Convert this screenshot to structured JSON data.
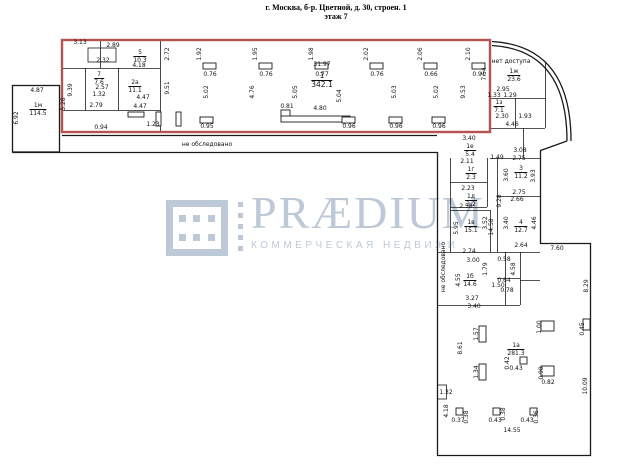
{
  "title": {
    "line1": "г. Москва, б-р. Цветной, д. 30, строен. 1",
    "line2": "этаж 7"
  },
  "watermark": {
    "brand": "PRÆDIUM",
    "tagline": "КОММЕРЧЕСКАЯ НЕДВИЖИМОСТЬ"
  },
  "colors": {
    "wall": "#1a1a1a",
    "highlight": "#b5534f",
    "watermark": "#bdc9d6"
  },
  "notes": {
    "no_access": "нет доступа",
    "not_surveyed": "не обследовано"
  },
  "rooms": [
    [
      "1",
      "342.1",
      322,
      72,
      1
    ],
    [
      "5",
      "10.3",
      140,
      49,
      0
    ],
    [
      "7",
      "7.6",
      99,
      71,
      0
    ],
    [
      "2а",
      "11.1",
      135,
      79,
      0
    ],
    [
      "1м",
      "114.5",
      38,
      102,
      0
    ],
    [
      "1ж",
      "23.6",
      514,
      68,
      0
    ],
    [
      "1з",
      "7.1",
      499,
      99,
      0
    ],
    [
      "1е",
      "5.4",
      470,
      143,
      0
    ],
    [
      "1г",
      "2.3",
      471,
      166,
      0
    ],
    [
      "1д",
      "2.2",
      471,
      193,
      0
    ],
    [
      "1в",
      "15.1",
      471,
      219,
      0
    ],
    [
      "3",
      "11.2",
      521,
      165,
      0
    ],
    [
      "4",
      "12.7",
      521,
      219,
      0
    ],
    [
      "1б",
      "14.6",
      470,
      273,
      0
    ],
    [
      "1а",
      "281.3",
      516,
      342,
      0
    ]
  ],
  "annotations": [
    [
      "1.92",
      200,
      54,
      1
    ],
    [
      "1.95",
      256,
      54,
      1
    ],
    [
      "1.98",
      312,
      54,
      1
    ],
    [
      "2.02",
      367,
      54,
      1
    ],
    [
      "2.06",
      421,
      54,
      1
    ],
    [
      "2.10",
      469,
      54,
      1
    ],
    [
      "0.76",
      210,
      75,
      0
    ],
    [
      "0.76",
      266,
      75,
      0
    ],
    [
      "0.77",
      322,
      75,
      0
    ],
    [
      "0.76",
      377,
      75,
      0
    ],
    [
      "0.66",
      431,
      75,
      0
    ],
    [
      "0.91",
      479,
      75,
      0
    ],
    [
      "31.97",
      322,
      65,
      0
    ],
    [
      "5.02",
      207,
      92,
      1
    ],
    [
      "4.76",
      253,
      92,
      1
    ],
    [
      "5.05",
      296,
      92,
      1
    ],
    [
      "5.04",
      340,
      96,
      1
    ],
    [
      "5.03",
      395,
      92,
      1
    ],
    [
      "5.02",
      437,
      92,
      1
    ],
    [
      "9.53",
      464,
      92,
      1
    ],
    [
      "7.54",
      485,
      74,
      1
    ],
    [
      "0.95",
      207,
      127,
      0
    ],
    [
      "0.81",
      287,
      107,
      0
    ],
    [
      "4.80",
      320,
      109,
      0
    ],
    [
      "0.96",
      349,
      127,
      0
    ],
    [
      "0.96",
      396,
      127,
      0
    ],
    [
      "0.96",
      439,
      127,
      0
    ],
    [
      "2.72",
      168,
      54,
      1
    ],
    [
      "9.51",
      168,
      88,
      1
    ],
    [
      "3.13",
      80,
      43,
      0
    ],
    [
      "2.89",
      113,
      46,
      0
    ],
    [
      "2.32",
      103,
      61,
      0
    ],
    [
      "4.18",
      139,
      66,
      0
    ],
    [
      "2.57",
      102,
      88,
      0
    ],
    [
      "1.32",
      99,
      95,
      0
    ],
    [
      "4.47",
      143,
      98,
      0
    ],
    [
      "2.79",
      96,
      106,
      0
    ],
    [
      "4.47",
      140,
      107,
      0
    ],
    [
      "0.94",
      101,
      128,
      0
    ],
    [
      "1.23",
      153,
      125,
      0
    ],
    [
      "9.39",
      71,
      90,
      1
    ],
    [
      "5.28",
      64,
      104,
      1
    ],
    [
      "4.87",
      37,
      91,
      0
    ],
    [
      "6.92",
      17,
      118,
      1
    ],
    [
      "не обследовано",
      207,
      145,
      0
    ],
    [
      "нет доступа",
      511,
      62,
      0
    ],
    [
      "2.95",
      503,
      90,
      0
    ],
    [
      "1.33",
      494,
      96,
      0
    ],
    [
      "1.29",
      510,
      96,
      0
    ],
    [
      "2.30",
      502,
      117,
      0
    ],
    [
      "1.93",
      525,
      117,
      0
    ],
    [
      "4.46",
      512,
      125,
      0
    ],
    [
      "3.08",
      520,
      151,
      0
    ],
    [
      "1.49",
      497,
      158,
      0
    ],
    [
      "3.40",
      469,
      139,
      0
    ],
    [
      "2.11",
      467,
      162,
      0
    ],
    [
      "2.23",
      468,
      189,
      0
    ],
    [
      "2.58",
      466,
      207,
      0
    ],
    [
      "5.95",
      457,
      228,
      1
    ],
    [
      "3.52",
      486,
      223,
      1
    ],
    [
      "14.58",
      492,
      227,
      1
    ],
    [
      "9.28",
      500,
      201,
      1
    ],
    [
      "2.75",
      519,
      159,
      0
    ],
    [
      "3.60",
      507,
      175,
      1
    ],
    [
      "3.93",
      534,
      176,
      1
    ],
    [
      "2.75",
      519,
      193,
      0
    ],
    [
      "2.66",
      517,
      200,
      0
    ],
    [
      "3.40",
      507,
      223,
      1
    ],
    [
      "4.46",
      535,
      223,
      1
    ],
    [
      "2.64",
      521,
      246,
      0
    ],
    [
      "2.74",
      469,
      252,
      0
    ],
    [
      "3.00",
      473,
      261,
      0
    ],
    [
      "0.58",
      504,
      260,
      0
    ],
    [
      "1.79",
      486,
      269,
      1
    ],
    [
      "4.58",
      514,
      269,
      1
    ],
    [
      "4.55",
      459,
      280,
      1
    ],
    [
      "0.64",
      504,
      281,
      0
    ],
    [
      "1.50",
      498,
      286,
      0
    ],
    [
      "0.78",
      507,
      291,
      0
    ],
    [
      "3.27",
      472,
      299,
      0
    ],
    [
      "3.40",
      474,
      307,
      0
    ],
    [
      "не обследовано",
      444,
      267,
      1
    ],
    [
      "7.60",
      557,
      249,
      0
    ],
    [
      "8.29",
      587,
      286,
      1
    ],
    [
      "8.61",
      461,
      348,
      1
    ],
    [
      "1.57",
      477,
      334,
      1
    ],
    [
      "1.34",
      477,
      372,
      1
    ],
    [
      "0.42",
      508,
      363,
      1
    ],
    [
      "0.43",
      516,
      369,
      0
    ],
    [
      "1.00",
      540,
      327,
      1
    ],
    [
      "0.98",
      542,
      373,
      1
    ],
    [
      "0.82",
      548,
      383,
      0
    ],
    [
      "0.45",
      583,
      329,
      1
    ],
    [
      "10.09",
      586,
      386,
      1
    ],
    [
      "1.32",
      446,
      393,
      0
    ],
    [
      "4.18",
      447,
      411,
      1
    ],
    [
      "0.37",
      458,
      421,
      0
    ],
    [
      "0.38",
      467,
      417,
      1
    ],
    [
      "0.43",
      495,
      421,
      0
    ],
    [
      "0.38",
      504,
      414,
      1
    ],
    [
      "0.43",
      527,
      421,
      0
    ],
    [
      "0.36",
      537,
      417,
      1
    ],
    [
      "14.55",
      512,
      431,
      0
    ]
  ]
}
